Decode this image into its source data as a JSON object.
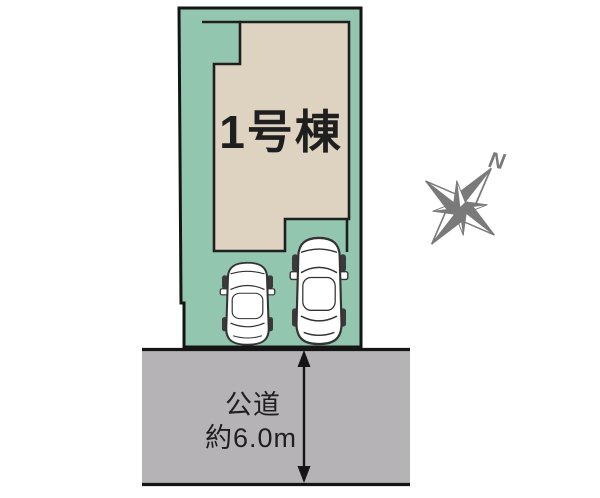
{
  "site_plan": {
    "building": {
      "label": "1号棟"
    },
    "road": {
      "name": "公道",
      "width": "約6.0m"
    },
    "compass": {
      "north": "N"
    },
    "colors": {
      "lot_green": "#93c6af",
      "building_beige": "#ddd3c0",
      "road_gray": "#b5b3b6",
      "outline_black": "#151515",
      "compass_gray": "#7a7a7a",
      "car_white": "#ffffff"
    }
  }
}
